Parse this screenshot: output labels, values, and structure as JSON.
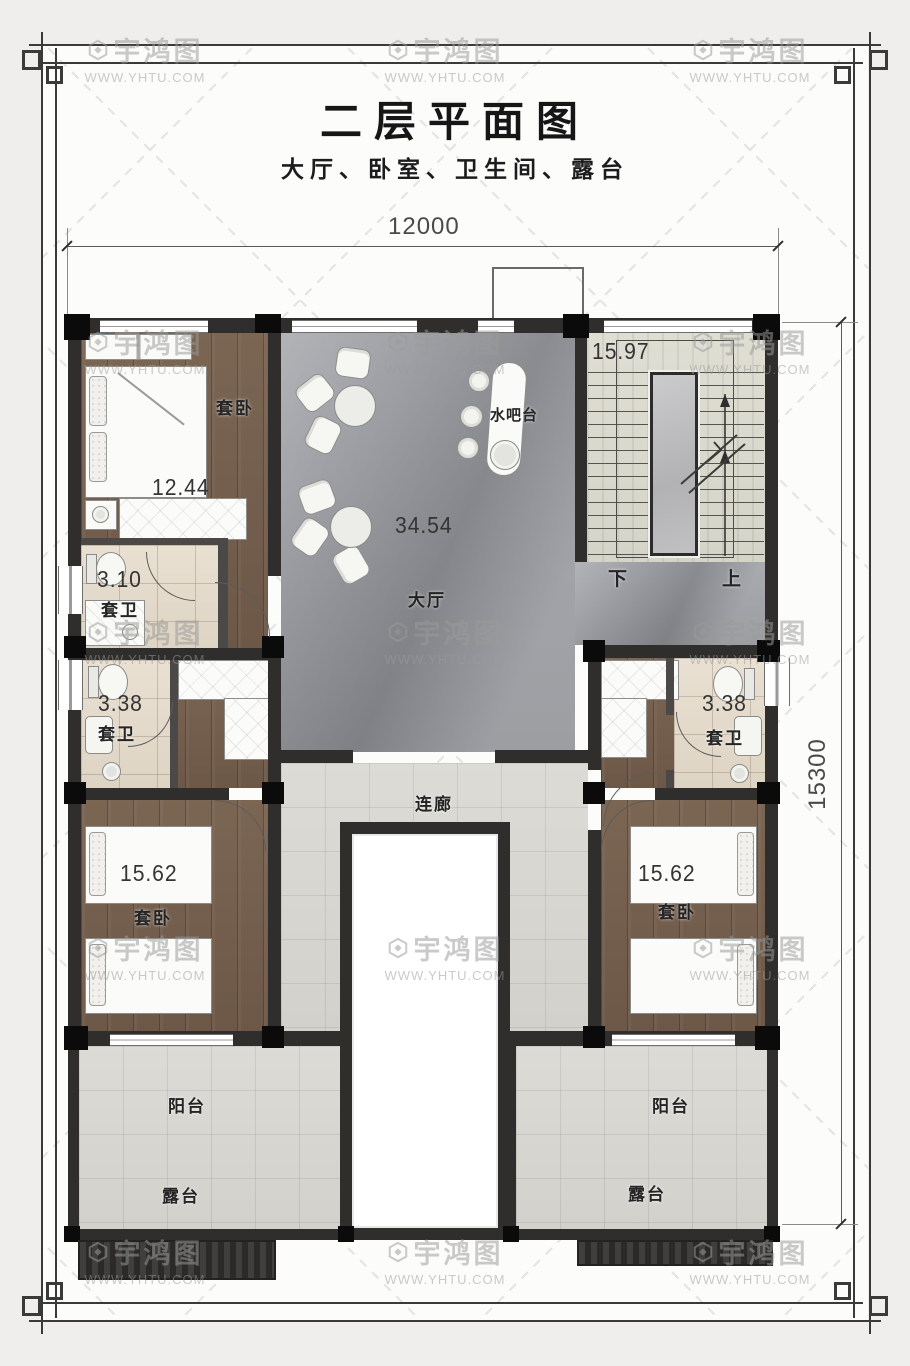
{
  "meta": {
    "watermark_brand": "宇鸿图",
    "watermark_url": "WWW.YHTU.COM"
  },
  "header": {
    "title": "二层平面图",
    "subtitle": "大厅、卧室、卫生间、露台"
  },
  "dimensions": {
    "width_total": "12000",
    "height_total": "15300"
  },
  "rooms": {
    "hall": {
      "name": "大厅",
      "area": "34.54"
    },
    "water_bar": {
      "name": "水吧台"
    },
    "stairs": {
      "area": "15.97",
      "down": "下",
      "up": "上"
    },
    "suite_bedroom_tl": {
      "name": "套卧",
      "area": "12.44"
    },
    "suite_bath_tl": {
      "name": "套卫",
      "area": "3.10"
    },
    "suite_bath_left": {
      "name": "套卫",
      "area": "3.38"
    },
    "suite_bedroom_left": {
      "name": "套卧",
      "area": "15.62"
    },
    "suite_bath_right": {
      "name": "套卫",
      "area": "3.38"
    },
    "suite_bedroom_right": {
      "name": "套卧",
      "area": "15.62"
    },
    "corridor": {
      "name": "连廊"
    },
    "balcony_left": {
      "name": "阳台"
    },
    "terrace_left": {
      "name": "露台"
    },
    "balcony_right": {
      "name": "阳台"
    },
    "terrace_right": {
      "name": "露台"
    }
  },
  "colors": {
    "wall": "#2f2e2c",
    "column": "#0b0b0b",
    "marble_floor": "#9a9ba0",
    "wood_floor": "#74604f",
    "bath_tile": "#e5dccd",
    "light_tile": "#d8d7d2",
    "stair_floor": "#dcdbd0",
    "page_background": "#efeeec"
  }
}
